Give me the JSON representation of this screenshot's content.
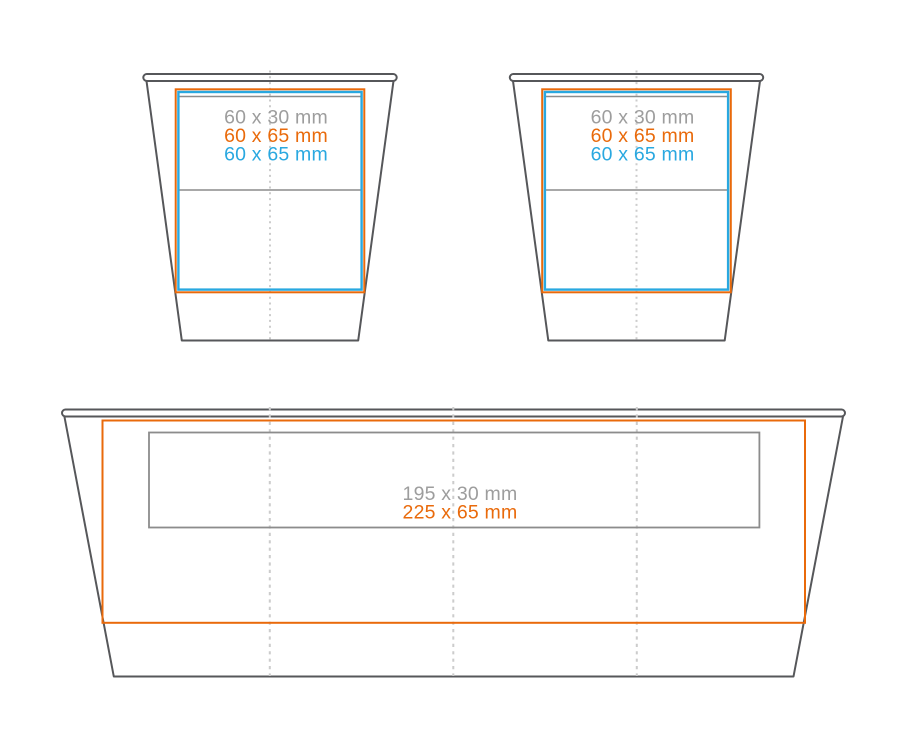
{
  "diagram": {
    "description_labels_only": "cup print-area template",
    "cups": [
      {
        "name": "small-cup-left",
        "labels": [
          {
            "text": "60 x 30 mm"
          },
          {
            "text": "60 x 65 mm"
          },
          {
            "text": "60 x 65 mm"
          }
        ]
      },
      {
        "name": "small-cup-right",
        "labels": [
          {
            "text": "60 x 30 mm"
          },
          {
            "text": "60 x 65 mm"
          },
          {
            "text": "60 x 65 mm"
          }
        ]
      }
    ],
    "tray": {
      "name": "large-wrap-area",
      "labels": [
        {
          "text": "195 x 30 mm"
        },
        {
          "text": "225 x 65 mm"
        }
      ]
    }
  },
  "colors": {
    "background": "#ffffff",
    "outline": "#56575a",
    "orange": "#e96a0b",
    "blue": "#29a8e0",
    "gray_line": "#8c8c8c",
    "gray_text": "#9d9d9d",
    "dash": "#cccccc"
  }
}
